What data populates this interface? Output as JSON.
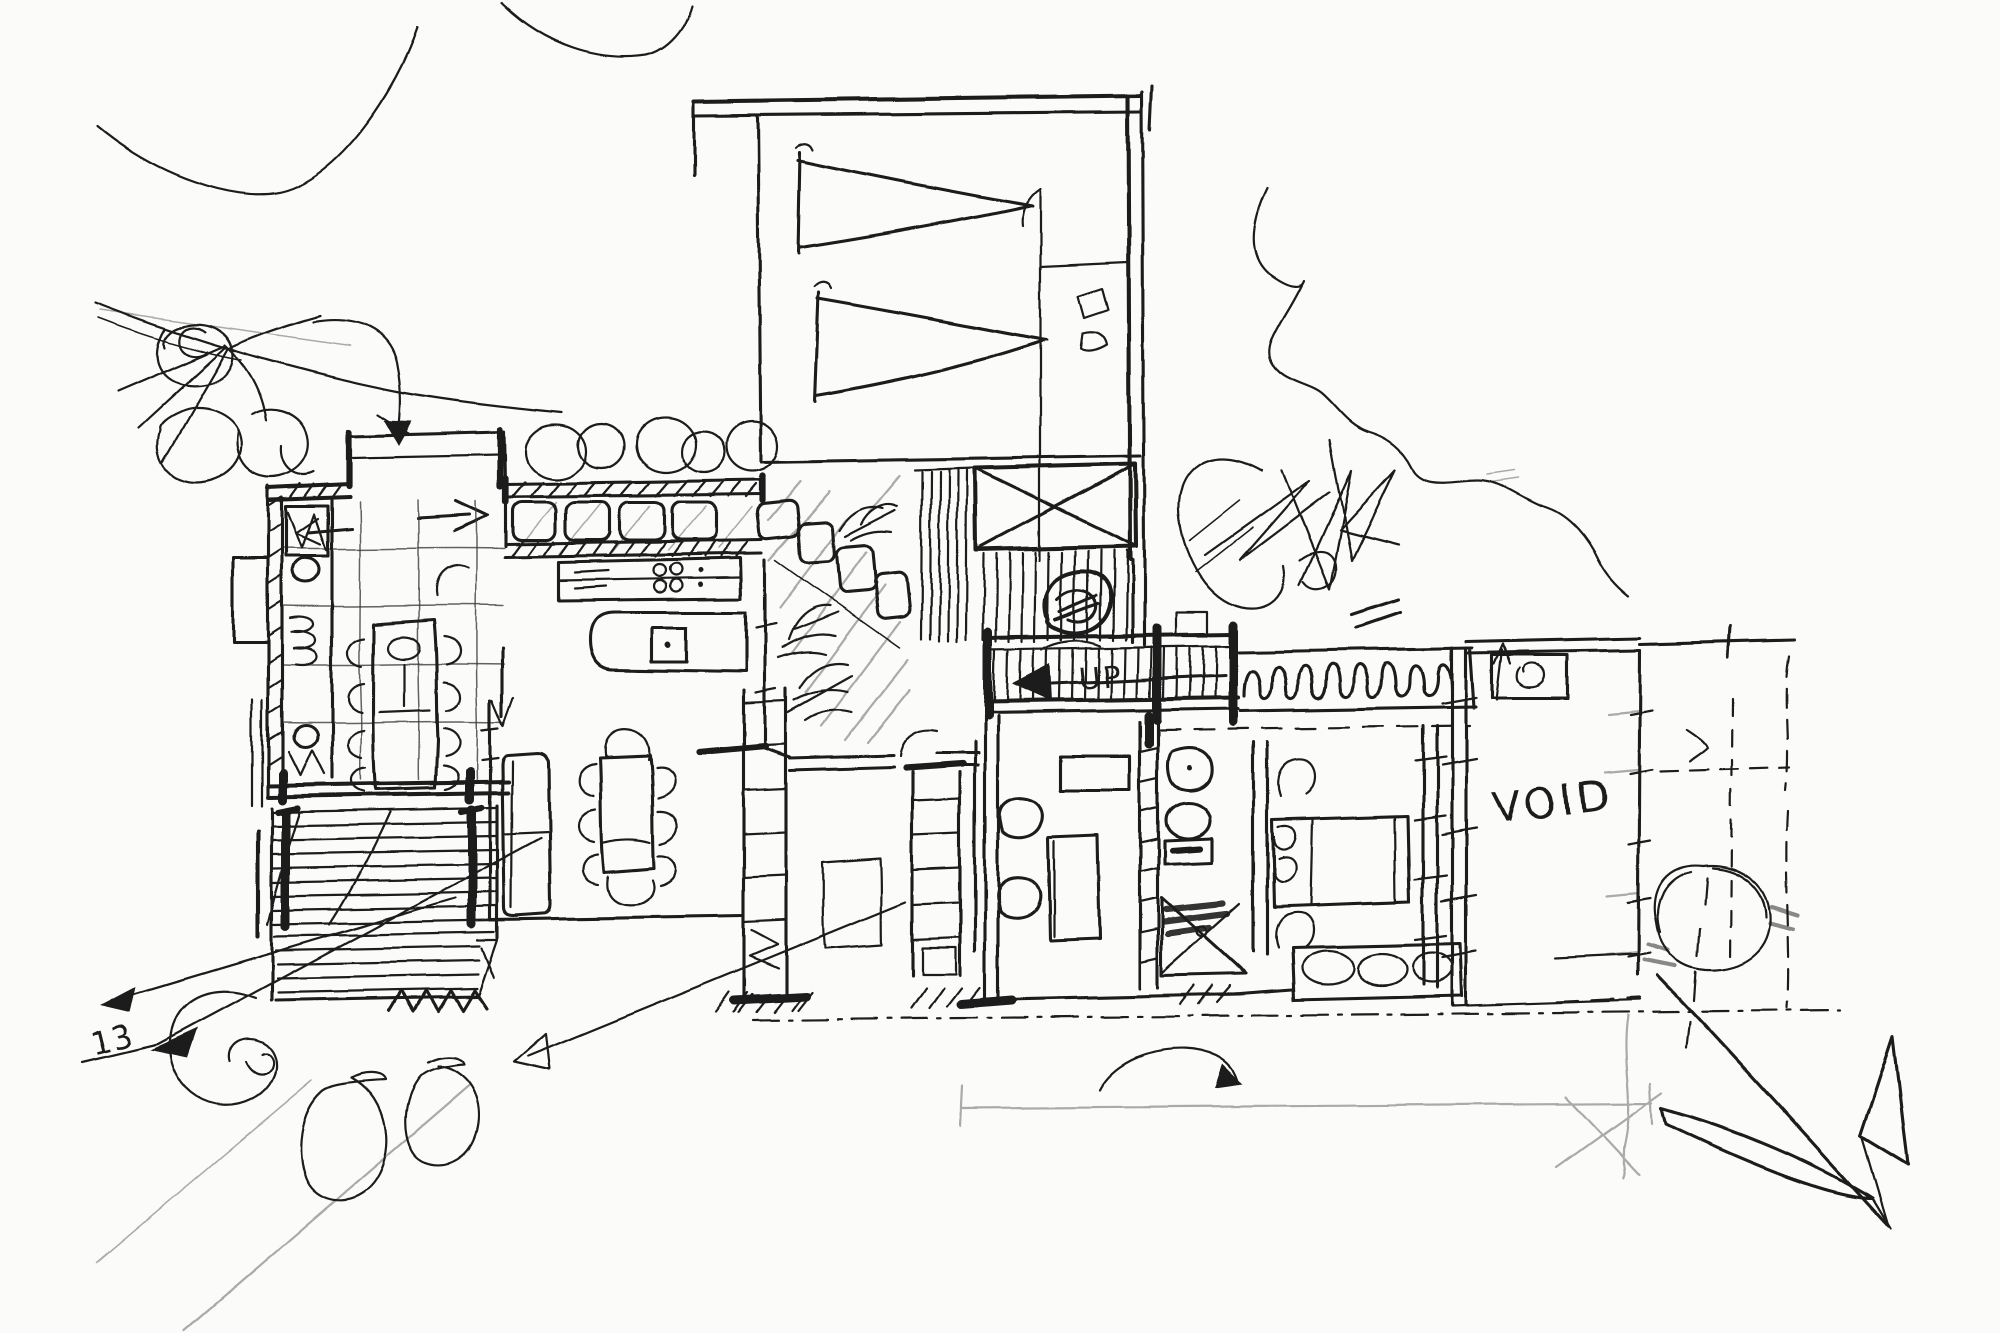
{
  "document": {
    "kind": "hand-drawn architectural concept floor plan sketch",
    "medium": "freehand black ink on white paper with light pencil construction lines"
  },
  "colors": {
    "paper": "#fbfbf9",
    "ink": "#1c1c1c",
    "pencil": "#aaaaaa"
  },
  "labels": {
    "void_room": "VOID",
    "stair_direction": "UP",
    "site_mark": "13"
  }
}
